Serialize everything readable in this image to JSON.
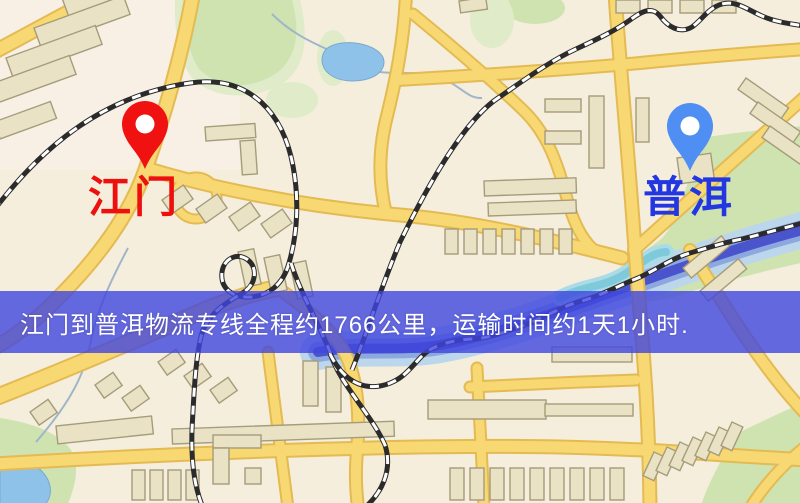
{
  "map": {
    "description": "stylized street map",
    "background_color": "#f5eedd",
    "road_color": "#f8d873",
    "railway_style": "black-white-dashed",
    "park_color": "#cfe3b1",
    "water_color": "#8fc2e9",
    "river_color": "#4a54cd"
  },
  "markers": [
    {
      "id": "origin",
      "label": "江门",
      "label_color": "#ee0f0f",
      "pin_color": "#f01111",
      "pin_icon": "red-location-pin"
    },
    {
      "id": "destination",
      "label": "普洱",
      "label_color": "#2236e2",
      "pin_color": "#4f8ef2",
      "pin_icon": "blue-location-pin"
    }
  ],
  "banner": {
    "text": "江门到普洱物流专线全程约1766公里，运输时间约1天1小时.",
    "background_color": "#4046de",
    "text_color": "#ffffff",
    "origin": "江门",
    "destination": "普洱",
    "distance_km": "1766",
    "duration": "1天1小时"
  }
}
